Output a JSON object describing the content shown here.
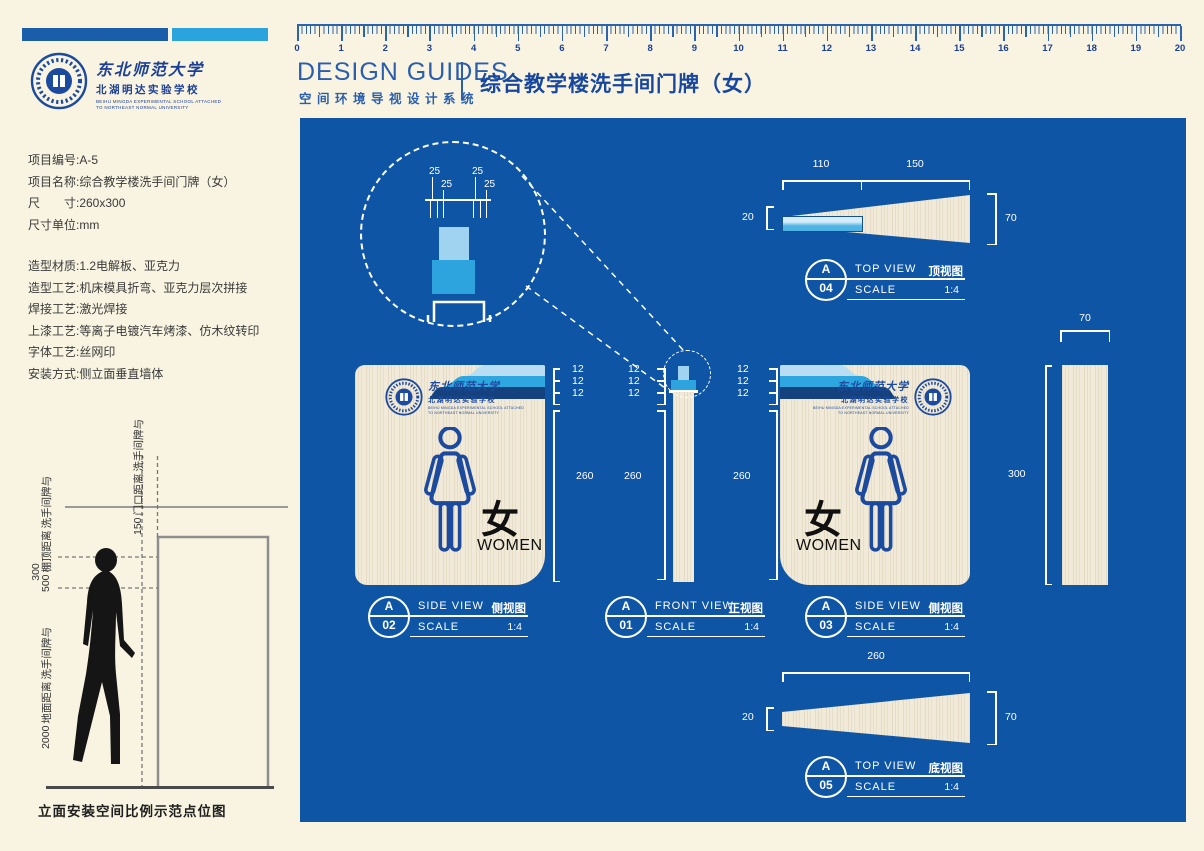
{
  "brand": {
    "university": "东北师范大学",
    "school": "北湖明达实验学校",
    "school_en1": "BEIHU MINGDA EXPERIMENTAL SCHOOL ATTACHED",
    "school_en2": "TO NORTHEAST NORMAL UNIVERSITY"
  },
  "header": {
    "design_guides": "DESIGN GUIDES",
    "system_cn": "空间环境导视设计系统",
    "page_title": "综合教学楼洗手间门牌（女）"
  },
  "ruler": {
    "units": [
      "0",
      "1",
      "2",
      "3",
      "4",
      "5",
      "6",
      "7",
      "8",
      "9",
      "10",
      "11",
      "12",
      "13",
      "14",
      "15",
      "16",
      "17",
      "18",
      "19",
      "20"
    ]
  },
  "project_info": {
    "lines": [
      "项目编号:A-5",
      "项目名称:综合教学楼洗手间门牌（女）",
      "尺　　寸:260x300",
      "尺寸单位:mm"
    ]
  },
  "craft_info": {
    "lines": [
      "造型材质:1.2电解板、亚克力",
      "造型工艺:机床模具折弯、亚克力层次拼接",
      "焊接工艺:激光焊接",
      "上漆工艺:等离子电镀汽车烤漆、仿木纹转印",
      "字体工艺:丝网印",
      "安装方式:侧立面垂直墙体"
    ]
  },
  "elevation": {
    "door_gap": {
      "value": "150",
      "line1": "门口距离",
      "line2": "洗手间牌与"
    },
    "ceiling_gap": {
      "value": "500",
      "line1": "棚顶距离",
      "line2": "洗手间牌与"
    },
    "sign_height": "300",
    "floor_gap": {
      "value": "2000",
      "line1": "地面距离",
      "line2": "洗手间牌与"
    },
    "caption": "立面安装空间比例示范点位图"
  },
  "panel": {
    "detail": {
      "d1": "25",
      "d2": "25",
      "d3": "25",
      "d4": "25"
    },
    "sign": {
      "cn": "女",
      "en": "WOMEN"
    },
    "dim_columns": [
      {
        "l1": "12",
        "l2": "12",
        "l3": "12",
        "height": "260"
      },
      {
        "l1": "12",
        "l2": "12",
        "l3": "12",
        "height": "260"
      },
      {
        "l1": "12",
        "l2": "12",
        "l3": "12",
        "height": "260"
      }
    ],
    "dims": {
      "a04": {
        "seg1": "110",
        "seg2": "150",
        "left": "20",
        "right": "70"
      },
      "a05": {
        "top": "260",
        "left": "20",
        "right": "70"
      },
      "side_panel": {
        "top": "70",
        "height": "300"
      }
    },
    "views": {
      "a01": {
        "letter": "A",
        "num": "01",
        "en": "FRONT VIEW",
        "cn": "正视图",
        "scale_label": "SCALE",
        "scale": "1:4"
      },
      "a02": {
        "letter": "A",
        "num": "02",
        "en": "SIDE VIEW",
        "cn": "侧视图",
        "scale_label": "SCALE",
        "scale": "1:4"
      },
      "a03": {
        "letter": "A",
        "num": "03",
        "en": "SIDE VIEW",
        "cn": "侧视图",
        "scale_label": "SCALE",
        "scale": "1:4"
      },
      "a04": {
        "letter": "A",
        "num": "04",
        "en": "TOP VIEW",
        "cn": "顶视图",
        "scale_label": "SCALE",
        "scale": "1:4"
      },
      "a05": {
        "letter": "A",
        "num": "05",
        "en": "TOP VIEW",
        "cn": "底视图",
        "scale_label": "SCALE",
        "scale": "1:4"
      }
    }
  },
  "colors": {
    "panel": "#0f55a6",
    "pale_blue": "#b9ddf3",
    "cyan": "#2ea7e0",
    "navy": "#15427e",
    "brand": "#1c4a9e",
    "wood": "#f1ead8",
    "cream": "#f8f4e1"
  }
}
